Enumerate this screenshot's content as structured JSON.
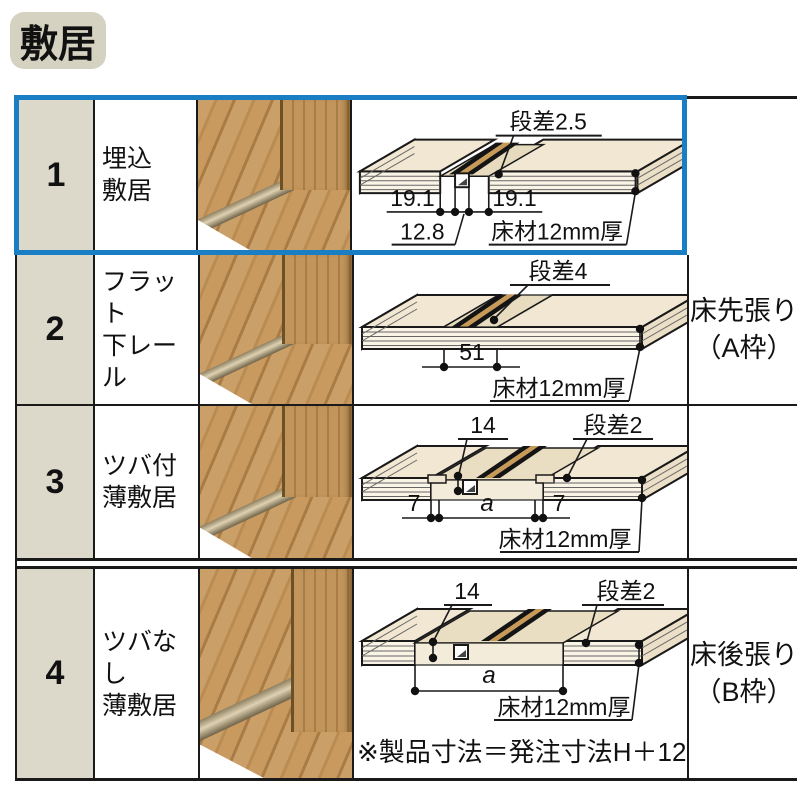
{
  "header": {
    "title": "敷居"
  },
  "colors": {
    "highlight_blue": "#1a7ec4",
    "number_cell_bg": "#dcd9ca",
    "badge_bg": "#d6d2c2",
    "line_black": "#1a1a1a"
  },
  "rows": [
    {
      "num": "1",
      "name_line1": "埋込",
      "name_line2": "敷居",
      "d": {
        "step": "段差2.5",
        "dim_l": "19.1",
        "dim_r": "19.1",
        "dim_b": "12.8",
        "floor": "床材12mm厚"
      }
    },
    {
      "num": "2",
      "name_line1": "フラット",
      "name_line2": "下レール",
      "d": {
        "step": "段差4",
        "dim_c": "51",
        "floor": "床材12mm厚"
      }
    },
    {
      "num": "3",
      "name_line1": "ツバ付",
      "name_line2": "薄敷居",
      "d": {
        "top": "14",
        "step": "段差2",
        "dim_l": "7",
        "dim_c": "a",
        "dim_r": "7",
        "floor": "床材12mm厚"
      }
    },
    {
      "num": "4",
      "name_line1": "ツバなし",
      "name_line2": "薄敷居",
      "d": {
        "top": "14",
        "step": "段差2",
        "dim_c": "a",
        "floor": "床材12mm厚"
      },
      "note": "※製品寸法＝発注寸法H＋12"
    }
  ],
  "side_labels": {
    "a": {
      "line1": "床先張り",
      "line2": "（A枠）"
    },
    "b": {
      "line1": "床後張り",
      "line2": "（B枠）"
    }
  }
}
